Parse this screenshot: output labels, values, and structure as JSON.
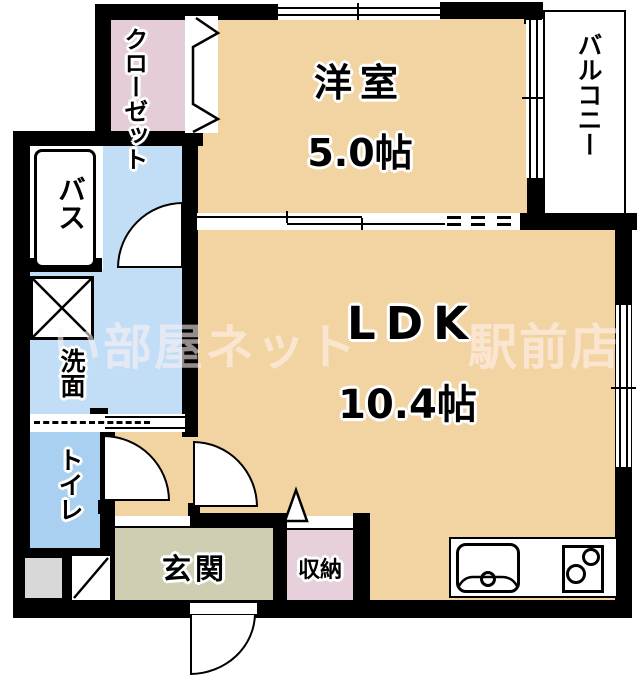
{
  "floorplan": {
    "rooms": {
      "western_room": {
        "name": "洋室",
        "size": "5.0帖"
      },
      "ldk": {
        "name": "LDK",
        "size": "10.4帖"
      },
      "closet": {
        "name": "クローゼット"
      },
      "balcony": {
        "name": "バルコニー"
      },
      "bath": {
        "name": "バス"
      },
      "washroom": {
        "name": "洗面"
      },
      "toilet": {
        "name": "トイレ"
      },
      "entrance": {
        "name": "玄関"
      },
      "storage": {
        "name": "収納"
      }
    },
    "watermark": {
      "left": "い部屋ネット",
      "right": "駅前店"
    },
    "colors": {
      "room_peach": "#f2d4a3",
      "closet_pink": "#e4cdd9",
      "storage_pink": "#e7cfdc",
      "washroom_blue": "#c2def6",
      "toilet_blue": "#a9d0f0",
      "entrance_khaki": "#cfcdb2",
      "meter_gray": "#d8d8d8",
      "wall_black": "#000000"
    }
  }
}
